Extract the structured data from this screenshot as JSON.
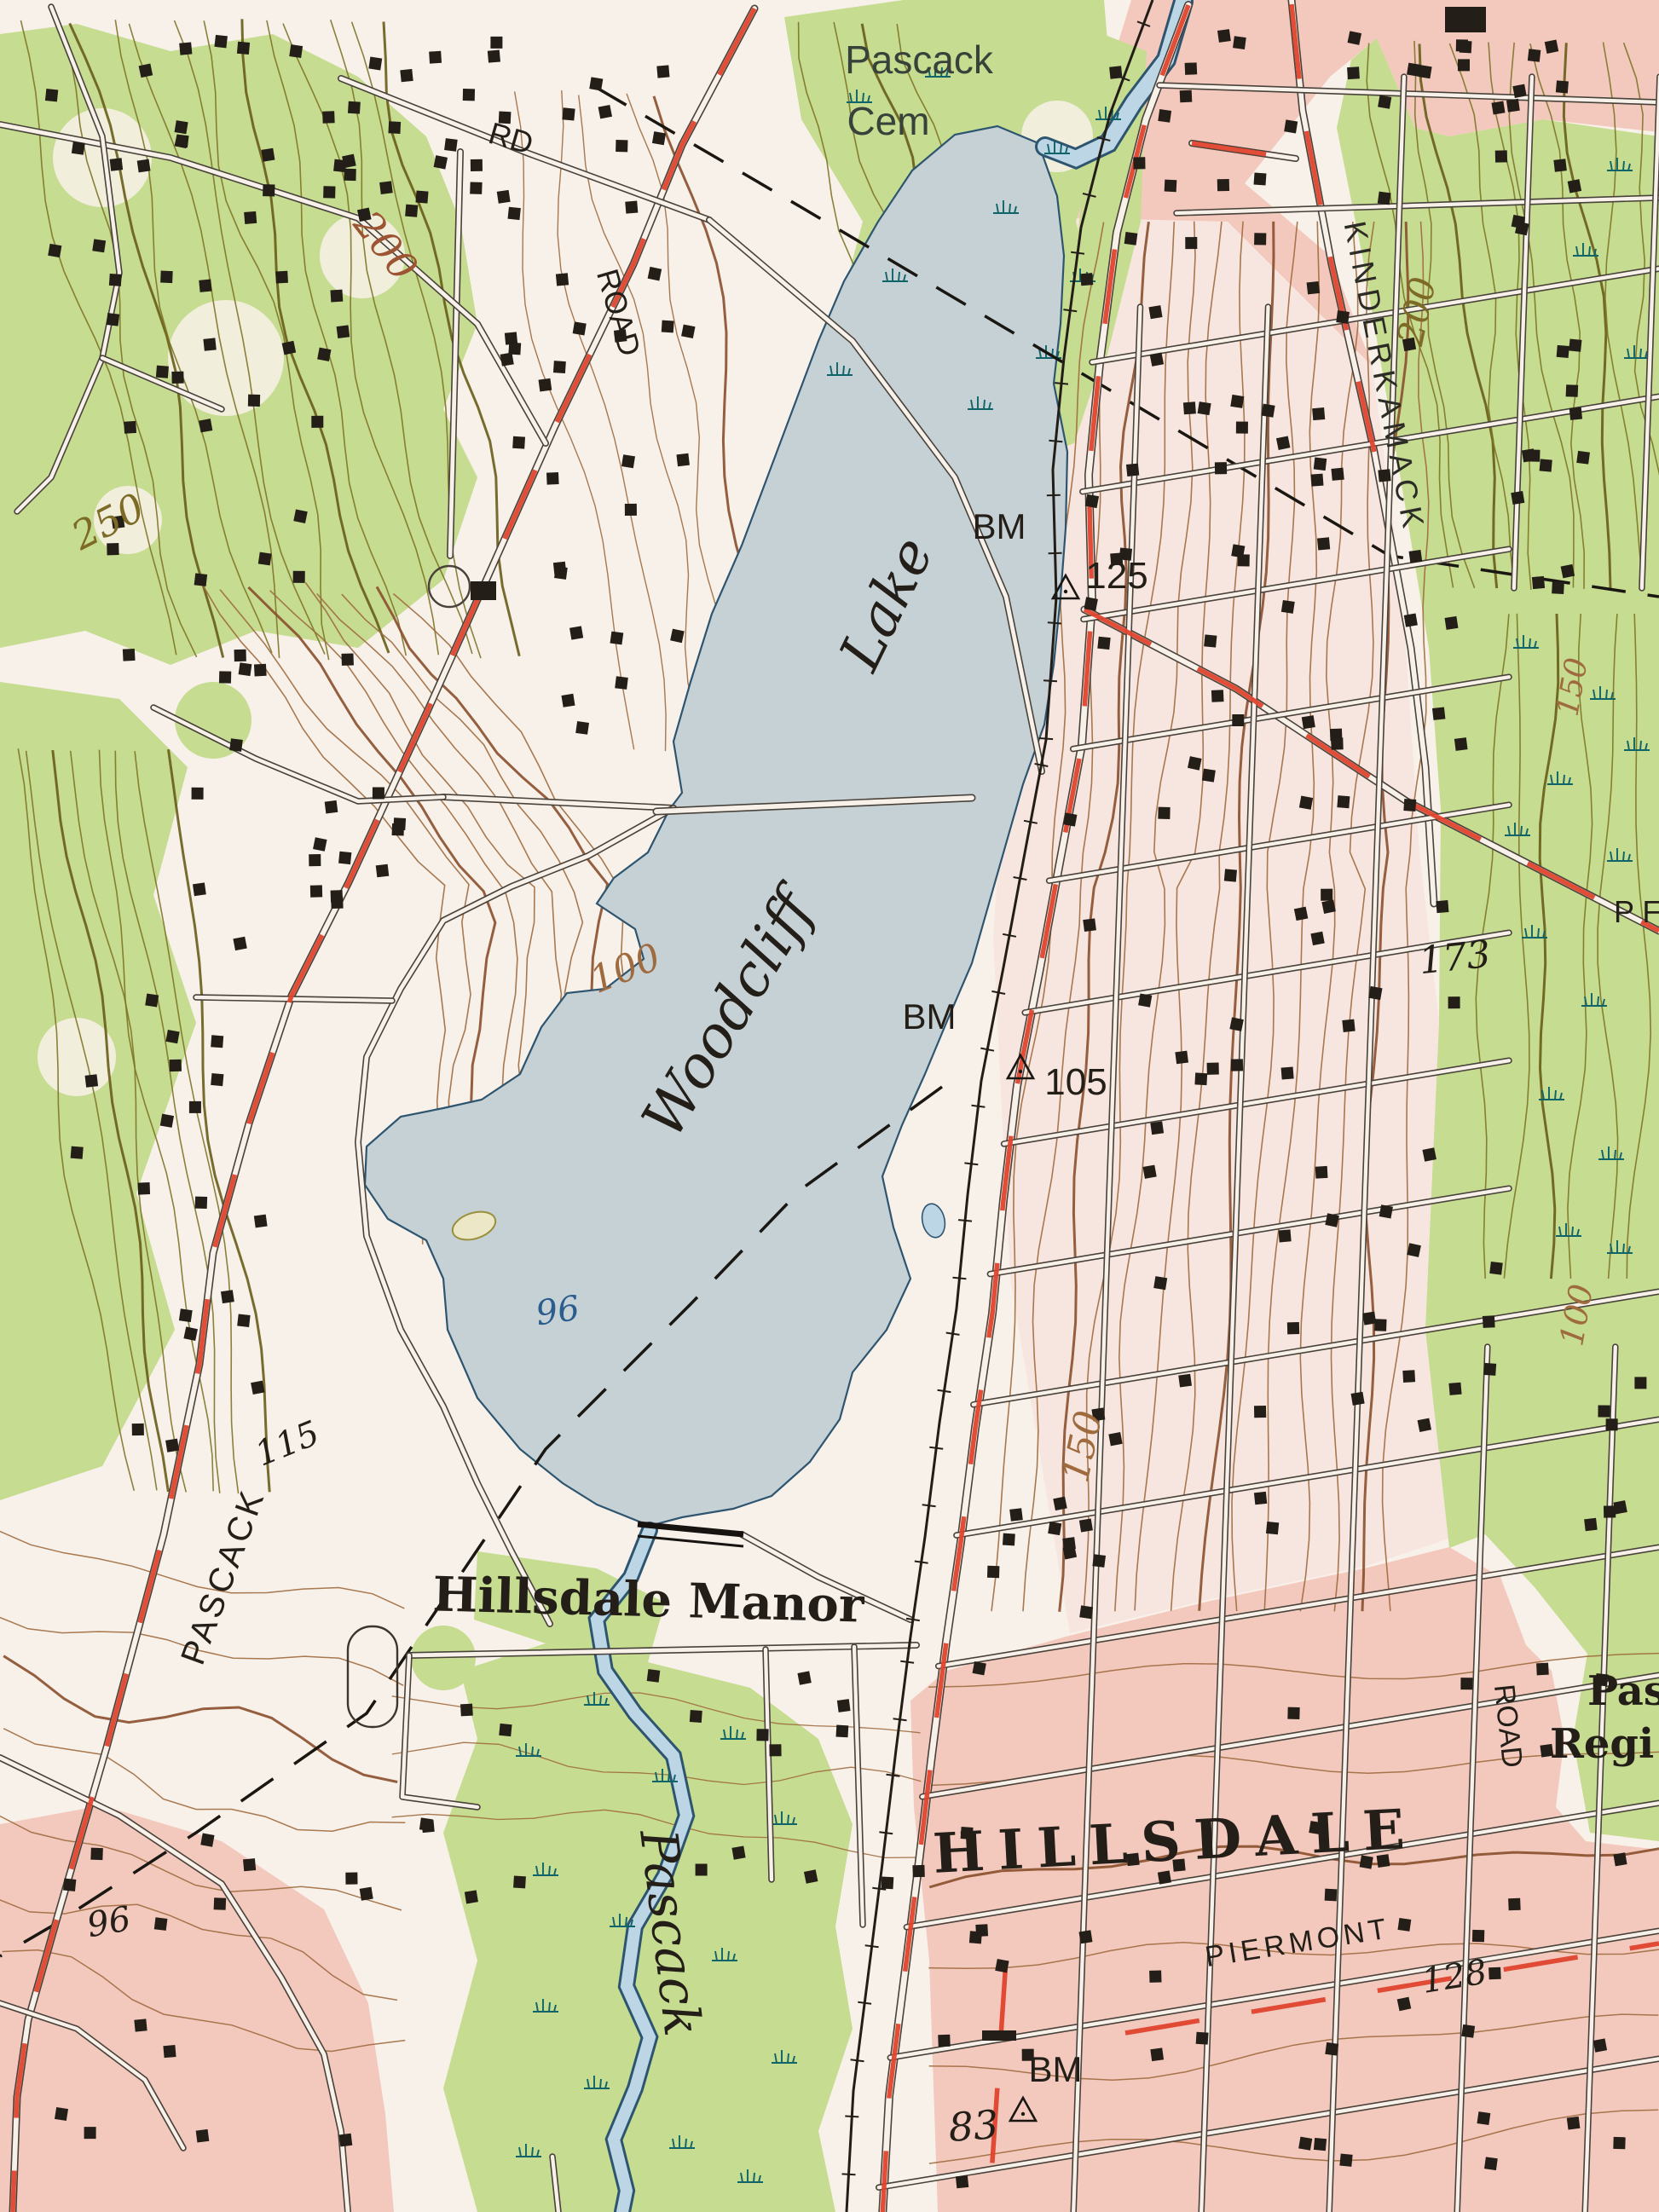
{
  "map": {
    "title": "Topographic map - Woodcliff Lake and Hillsdale",
    "colors": {
      "paper": "#f8f1ea",
      "pale_zone": "#f7e0d7",
      "urban_pink": "#f3c9bd",
      "woodland": "#c6dc90",
      "water_fill": "#c6d1d5",
      "water_edge": "#2e5570",
      "stream_fill": "#bcd6e6",
      "contour_brown": "#9e6a3e",
      "contour_brown_index": "#8a4f2c",
      "contour_olive": "#7d7428",
      "contour_olive_index": "#685d18",
      "road_red": "#df432d",
      "road_casing": "#48423a",
      "ink": "#231e18",
      "marsh": "#0e6468",
      "water_label": "#2b5c8e",
      "contour_label_olive": "#7c6a26",
      "contour_label_red": "#9c5432",
      "cem_label": "#39423a"
    },
    "labels": {
      "cemetery_line1": "Pascack",
      "cemetery_line2": "Cem",
      "kinderkamack_road": "KINDERKAMACK",
      "rd_abbrev": "RD",
      "road_top_left": "ROAD",
      "road_right_edge": "ROAD",
      "contour_200_left": "200",
      "contour_200_right": "200",
      "contour_250": "250",
      "contour_150_upper_right": "150",
      "contour_150_mid": "150",
      "contour_100_west": "100",
      "contour_100_right": "100",
      "spot_115": "115",
      "spot_173": "173",
      "spot_128": "128",
      "spot_96_lake": "96",
      "spot_96_southwest": "96",
      "spot_83": "83",
      "bm_125_label": "BM",
      "bm_125_value": "125",
      "bm_105_label": "BM",
      "bm_105_value": "105",
      "bm_83_label": "BM",
      "lake_name_line1": "Woodcliff",
      "lake_name_line2": "Lake",
      "hillsdale_manor": "Hillsdale Manor",
      "hillsdale": "HILLSDALE",
      "piermont_road": "PIERMONT",
      "pascack_road": "PASCACK",
      "pascack_brook": "Pascack",
      "truncated_right_line1": "Pas",
      "truncated_right_line2": "Regi",
      "truncated_right_road": "P F"
    }
  }
}
